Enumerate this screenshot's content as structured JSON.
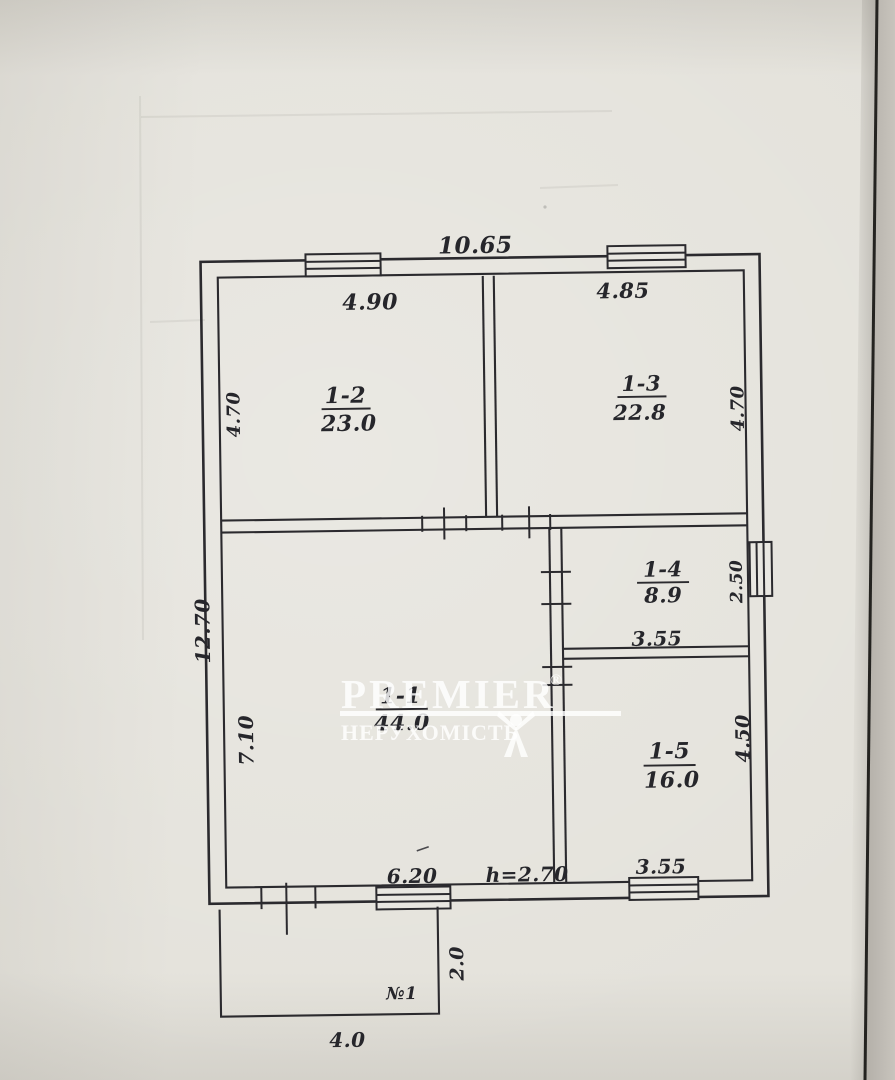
{
  "watermark": {
    "brand": "PREMIER",
    "registered": "®",
    "subtitle": "НЕРУХОМІСТЬ"
  },
  "plan": {
    "overall_width": "10.65",
    "overall_height": "12.70",
    "ceiling_height": "h=2.70",
    "rooms": [
      {
        "id": "1-2",
        "area": "23.0",
        "width": "4.90",
        "height": "4.70"
      },
      {
        "id": "1-3",
        "area": "22.8",
        "width": "4.85",
        "height": "4.70"
      },
      {
        "id": "1-1",
        "area": "44.0",
        "width": "6.20",
        "height": "7.10"
      },
      {
        "id": "1-4",
        "area": "8.9",
        "width": "3.55",
        "height": "2.50"
      },
      {
        "id": "1-5",
        "area": "16.0",
        "width": "3.55",
        "height": "4.50"
      }
    ],
    "porch": {
      "id": "№1",
      "width": "4.0",
      "depth": "2.0"
    }
  },
  "colors": {
    "paper": "#e4e2db",
    "ink": "#2b2a2e",
    "watermark": "#ffffff"
  }
}
